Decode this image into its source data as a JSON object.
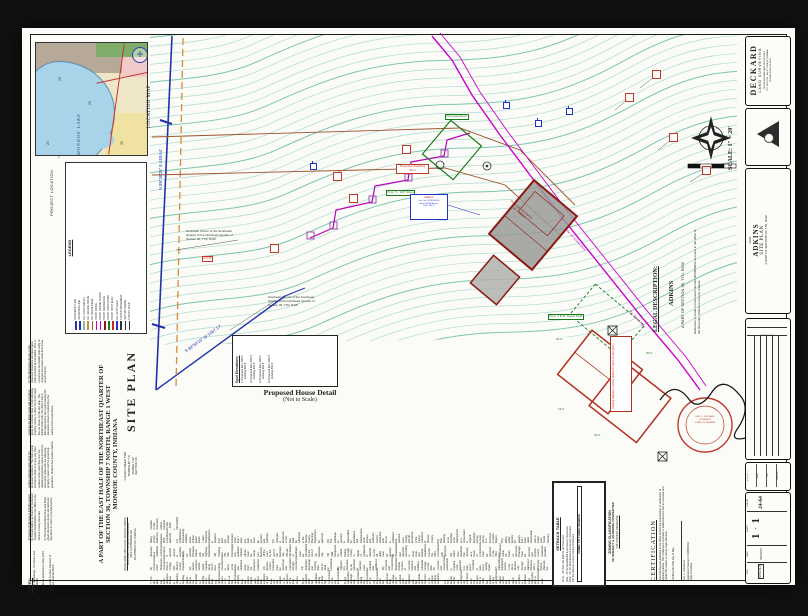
{
  "title_header": {
    "main": "SITE PLAN",
    "line1": "A PART OF THE EAST HALF OF THE NORTHEAST QUARTER OF",
    "line2": "SECTION 36, TOWNSHIP 7 NORTH, RANGE 1 WEST",
    "line3": "MONROE COUNTY, INDIANA"
  },
  "township_block": {
    "lines": [
      "CLEAR CREEK TWP",
      "TOWNSHIP 7 N",
      "RANGE 1 W",
      "SECTION 36"
    ]
  },
  "developer_block": {
    "lines": [
      "DEVELOPER-APPLICANT: DONALD ADKINS",
      "DOCUMENT NUMBER 2023009264",
      "3013 CLAYBRIDGE DR",
      "BLOOMINGTON, INDIANA"
    ]
  },
  "location_map": {
    "label": "LOCATION MAP",
    "project_location": "PROJECT LOCATION",
    "lake_label": "MONROE LAKE",
    "numbers": [
      "26",
      "25",
      "23",
      "35"
    ]
  },
  "legend": {
    "title": "LEGEND",
    "entries": [
      {
        "label": "PROPERTY LINE",
        "color": "#2233aa"
      },
      {
        "label": "ADJOINER LINE",
        "color": "#2233aa"
      },
      {
        "label": "EX. CONTOUR (1')",
        "color": "#7ec4b2"
      },
      {
        "label": "EX. GRAVEL DRIVE",
        "color": "#d78b3a"
      },
      {
        "label": "EX. DRIVE EDGE",
        "color": "#a0522d"
      },
      {
        "label": "PROP. DRIVE",
        "color": "#cc00cc"
      },
      {
        "label": "PROP. GRADE SLOPE",
        "color": "#bb00bb"
      },
      {
        "label": "PROP. RESIDENCE",
        "color": "#8b1a12"
      },
      {
        "label": "PROP. STRUCTURE",
        "color": "#1a7a1a"
      },
      {
        "label": "PROP. SPOT ELEV.",
        "color": "#cc2222"
      },
      {
        "label": "EX. SPOT ELEV.",
        "color": "#2233cc"
      },
      {
        "label": "FOUND MONUMENT",
        "color": "#333333"
      },
      {
        "label": "SET 5/8\" REBAR",
        "color": "#333333"
      },
      {
        "label": "UTILITY POLE",
        "color": "#333333"
      }
    ]
  },
  "notes_left": {
    "header": "NOTES:",
    "items": [
      "1) Basis of Bearings - Per Deed, Inst. 2023009264.",
      "2) Fieldwork performed in May 2024.",
      "3) Proposed 1st floor elevation of residence shall be 663.9'.",
      "4) Source of title now or formerly owned by Donald Adkins as found on Instrument Number 2023009264 in the Office of the Monroe County Recorder.",
      "5) The proposed finish floor and finish grade elevations shown are minimum elevations in order to provide positive surface drainage away from the proposed residence. The finish grade elevations shall not in any way shed surface storm water flow onto the adjoining properties unless provisions have been made with the adjoining property owners and the governing jurisdiction. Shallow flow swales shall be made by the finish grade sub-contractor along the common lines to help adjoining property owners to direct the storm water flow as shown on this plot plan. The builder shall notify this office if site or field adjustments are made lowering the elevations shown or redirecting the surface storm water flows.",
      "6) The dimensions shown on the proposed residence are based upon plans provided by the builder. Prior to construction the builder shall verify no changes have been made from those shown hereon."
    ]
  },
  "notes_bottom": {
    "items": [
      "7) The plot plan has been prepared for use in obtaining a building permit and is not intended to identify lot or property lines. The dimensions shown to lot lines or the approximate property lines are shown based upon limited field evidence of said lines and are subject to the accuracy of the lines shown.",
      "8) No wetlands shall be disturbed during or after the construction of the site improvements.",
      "9) Any subsurface drainage tiles encountered during the construction of the site improvements shall be protected from damage and if severed shall be repaired with like materials and restored to the original working condition.",
      "10) The builder and/or any underground site contractor shall call Indiana 811 to verify the location of any underground utilities on this site and report any conflicts to Deckard Land Surveying prior to commencing work.",
      "11) Construction drive: Temporary construction drive to comply with Monroe County requirements.",
      "12) Gravel entrance: Gentle swale required along the lot lines during construction to direct storm water and sediment away from the proposed residence.",
      "13) Erosion control measures must be functional and maintained through construction.",
      "14) Sediment discharge and tracking from the lot shall be minimized.",
      "15) Adjacent lots disturbed by an individual lot operator must be repaired and stabilized.",
      "16) Concrete and Concentrated Washwater: Include location of concrete washout and building materials storage on site plan. All concrete and concentrated washwater is required to be captured in a leak-proof container or leak-proof settling basin.",
      "17) Ingress/Egress: Equipment access to the site is allowed only through the approved driveway with a Driveway Permit. Maintain the driveway as a stabilized construction entrance. If another access is required, apply for another Driveway Permit with the Highway Department.",
      "18) Tracking and Off-Site Discharges: Any sediment tracked off site must be swept (not flushed) off the road by the end of the business day. Off-site discharges of sediment must be remediated by the end of the business day.",
      "19) Spill Response: No vehicle fueling, storage of fuel, or repair of equipment is allowed on site. All spills must be cleaned up immediately and reported according to local, state, and federal regulations. Contact the MS4 Coordinator with questions.",
      "20) Karst: New sinkholes that develop as a result of construction must be reported to the MS4 Coordinator within 24 hours of discovery. Drainage must be restored and erosion control measures installed. Filling of new sinkholes requires MS4 Coordinator approval.",
      "21) Stabilization: Permanently stabilize areas of final grade within 7 days. Temporary stabilization is required if an area will remain dormant more than 7 days. Any bare soil must be seeded and mulched.",
      "22) Changes or deviations to this plan shall be submitted to the Monroe County Planning Department for approval.",
      "23) The individual lot operator is responsible for installation and maintenance of all erosion and sediment control measures until the lot is stabilized. The operator must comply with all provisions of the zoning ordinance of Monroe County.",
      "24) This drawing is not intended to be represented as a retracement or original boundary survey, a route survey, or a Surveyor Location Report.",
      "25) I affirm, under penalty for perjury, that I have taken reasonable care to redact each Social Security Number in this document, unless required by law.  - ERIC L. DECKARD"
    ]
  },
  "plan": {
    "bearing_north": "N 89°38'26\" E   453.64'",
    "bearing_south": "S 89°54'15\" W   1367.17'",
    "scale_label": "SCALE: 1\" = 20'",
    "corner_label_1": "Northeast Corner of the Southeast Quarter of the Northeast Quarter of Section 36, T7N, R1W",
    "corner_label_2": "Southeast Corner of the Southeast Quarter of the Northeast Quarter of Section 36, T7N, R1W",
    "pob": "P.O.B.",
    "dwelling_spot": "Proposed Dwelling Spot",
    "deck_label": "Proposed Deck",
    "slope_label": "Prop. 5 - 125' Slope",
    "septic_label": "Prop. 4 B.R. Septic Field",
    "drive_label": "Prop. 12' Gravel Drive",
    "ex_drive_label": "Ex. Gravel Drive",
    "house_text_1": "Proposed Residence",
    "house_text_2": "FF = 663.9'",
    "info_box": {
      "lines": [
        "Adkins",
        "Inst. No. 2023009264",
        "Area: 68.68 Acres±",
        "Elev. 656.9'"
      ]
    }
  },
  "spot_box": {
    "title": "Spot Elevations:",
    "entries": [
      {
        "p": "1) Proposed Elev. 664.1'",
        "e": "Existing 660.4'"
      },
      {
        "p": "2) Proposed Elev. 664.3'",
        "e": "Existing 662.0'"
      },
      {
        "p": "3) Proposed Elev. 664.1'",
        "e": "Existing 662.4'"
      },
      {
        "p": "4) Proposed Elev. 664.3'",
        "e": "Existing 660.3'"
      }
    ]
  },
  "house_detail": {
    "title": "Proposed House Detail",
    "subtitle": "(Not to Scale)",
    "grading_note": "Grading adjacent to home shall be 6\" fall in 10 feet (min.)",
    "labels": [
      "24.0'",
      "30.0'",
      "40.0'",
      "12.0'"
    ]
  },
  "legal": {
    "heading": "LEGAL DESCRIPTION:",
    "name": "ADKINS",
    "part": "A PART OF SECTION 36, T7N, R1W",
    "reference": "Reference is made to Instrument Number 2023009264 as found in the office of the Recorder of Monroe County, Indiana."
  },
  "setback_table": {
    "title": "SETBACK TABLE",
    "rows": [
      "Front - 25' from the R/W for all Structures",
      "Side - 15' for Residential & Accessory Structures",
      "Rear - 10' for Residential & Accessory Structures",
      "Per the Monroe County Zoning Ordinance"
    ],
    "zoned": "ZONED: 'FR' FOREST RESERVE"
  },
  "zoning": {
    "line1": "ZONING CLASSIFICATION",
    "line2": "OF SUBJECT & ADJOINING PROPERTIES",
    "line3": "'FR' FOREST RESERVE"
  },
  "certification": {
    "heading": "CERTIFICATION",
    "body": "This drawing was prepared in the office without the examination or verification of adjoining deeds. This certification is limited to additional facts that an accurate and careful title search or survey might disclose.",
    "certified": "Certified this    16th    day of    May",
    "name": "Eric L. Deckard",
    "reg": "Registered Surveyor LS29900012",
    "state": "State of Indiana"
  },
  "seal": {
    "line1": "ERIC L. DECKARD",
    "line2": "LS29900012",
    "line3": "STATE OF INDIANA"
  },
  "title_block": {
    "firm": {
      "name": "DECKARD",
      "sub": "LAND SURVEYING",
      "lines": [
        "PROFESSIONAL LAND SURVEYORS",
        "P.O. BOX 874 - ELLETTSVILLE, INDIANA",
        "PHONE (812) 876-8191"
      ]
    },
    "project": {
      "job_small": "24-64",
      "client": "ADKINS",
      "type": "SITE PLAN",
      "part": "A PART OF SECTION 36, T7N, R1W"
    },
    "revisions_title": "REVISIONS",
    "cells": [
      "S.D.L.R. TT",
      "WRL",
      "TLD",
      "RECON"
    ],
    "job": {
      "job_label": "JOB NO.",
      "job_no": "24-64",
      "sheet_label": "SHEET",
      "sheet_a": "1",
      "sheet_dash": "-",
      "sheet_b": "1",
      "date_label": "DATE",
      "date": "05/16/24",
      "file_label": "FILE",
      "file": "SITE.SHT"
    }
  }
}
